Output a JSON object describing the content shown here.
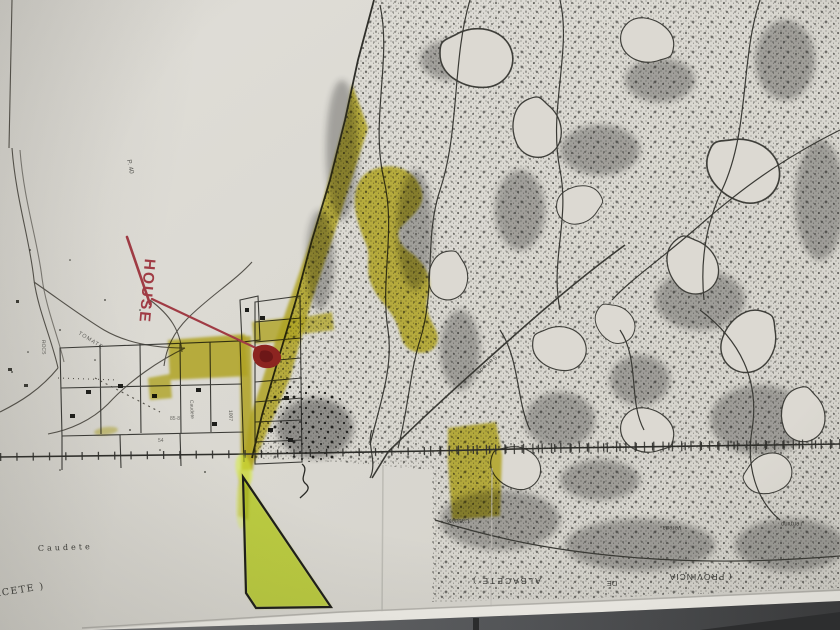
{
  "photo": {
    "description": "Photocopied cadastral map sheet of Caudete (Albacete) lying on a dark table, with yellow highlighter marks, a bright yellow-green triangle, and a red pen annotation pointing to a house location",
    "colors": {
      "paper": "#dcd9d2",
      "ink": "#35352f",
      "highlight_olive": "#ccc02a",
      "highlight_bright": "#d8ef3c",
      "red_pen": "#a03b44",
      "red_marker": "#8c2420",
      "table": "#4e5052"
    }
  },
  "annotations": {
    "house_label": "HOUSE"
  },
  "map_labels": {
    "town": "Caudete",
    "sheet_corner": "ACETE )",
    "small_plot": "P. 40",
    "road_left": "TOMATE",
    "road_left2": "ROCS",
    "village_street": "Caudete",
    "plot_number": "1007",
    "plot_number2": "54",
    "plot_number3": "85·8",
    "path_label": "Señeda",
    "term1": "Término",
    "term2": "Vereda",
    "term3": "Caudete",
    "prov1": "( PROVINCIA",
    "prov2": "DE",
    "prov3": "ALBACETE )"
  }
}
